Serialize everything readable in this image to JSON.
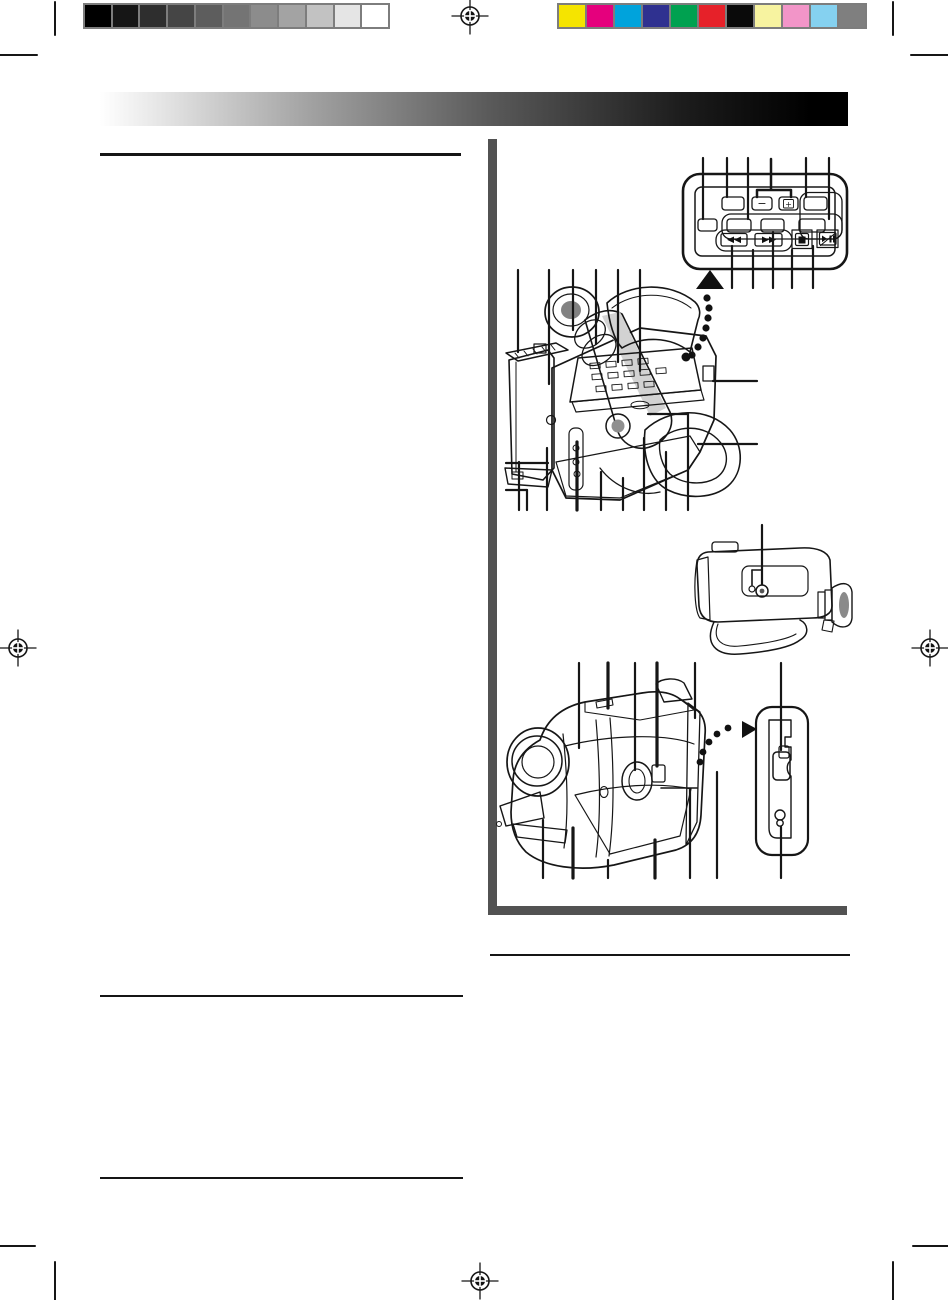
{
  "document": {
    "kind": "Scanned camcorder instruction-manual page (diagram column on right, body text blank)",
    "visible_text_glyphs": [
      "−",
      "+"
    ]
  },
  "print_calibration": {
    "grayscale_strip": {
      "colors": [
        "#000000",
        "#161616",
        "#2e2e2e",
        "#454545",
        "#5d5d5d",
        "#747474",
        "#8c8c8c",
        "#a3a3a3",
        "#c2c2c2",
        "#e5e5e5",
        "#ffffff"
      ],
      "border_color": "#7d7d7d"
    },
    "color_strip": {
      "colors": [
        "#f5e400",
        "#e5007d",
        "#00a3dc",
        "#2f3190",
        "#00a150",
        "#e62129",
        "#0a0a0a",
        "#f7f3a0",
        "#f295c8",
        "#85d1f0",
        "#7f7f7f"
      ],
      "border_color": "#7d7d7d"
    }
  },
  "header": {
    "gradient_start": "#ffffff",
    "gradient_end": "#000000"
  },
  "layout_colors": {
    "paper": "#ffffff",
    "frame_gray": "#525252",
    "rule_black": "#151515",
    "line_art_stroke": "#161616"
  },
  "remote_panel": {
    "minus_label": "−",
    "plus_label": "+",
    "transport_icons": [
      "rewind-icon",
      "fast-forward-icon",
      "stop-icon",
      "play-pause-icon"
    ]
  },
  "figures": [
    {
      "id": "control-panel-closeup",
      "description": "Close-up of pop-up control panel with −/+ and transport buttons, leader lines, up arrow with dotted trail"
    },
    {
      "id": "camcorder-rear-view",
      "description": "Rear 3/4 view: viewfinder, battery pack, open cover, keypad, hand strap, leader lines"
    },
    {
      "id": "camcorder-side-view",
      "description": "Side view with tripod-socket detail and leader line"
    },
    {
      "id": "camcorder-front-view",
      "description": "Front 3/4 view with lens, zoom lever, dotted arrow to latch detail"
    },
    {
      "id": "battery-release-detail",
      "description": "Enlarged battery-release latch / keyhole panel"
    }
  ]
}
